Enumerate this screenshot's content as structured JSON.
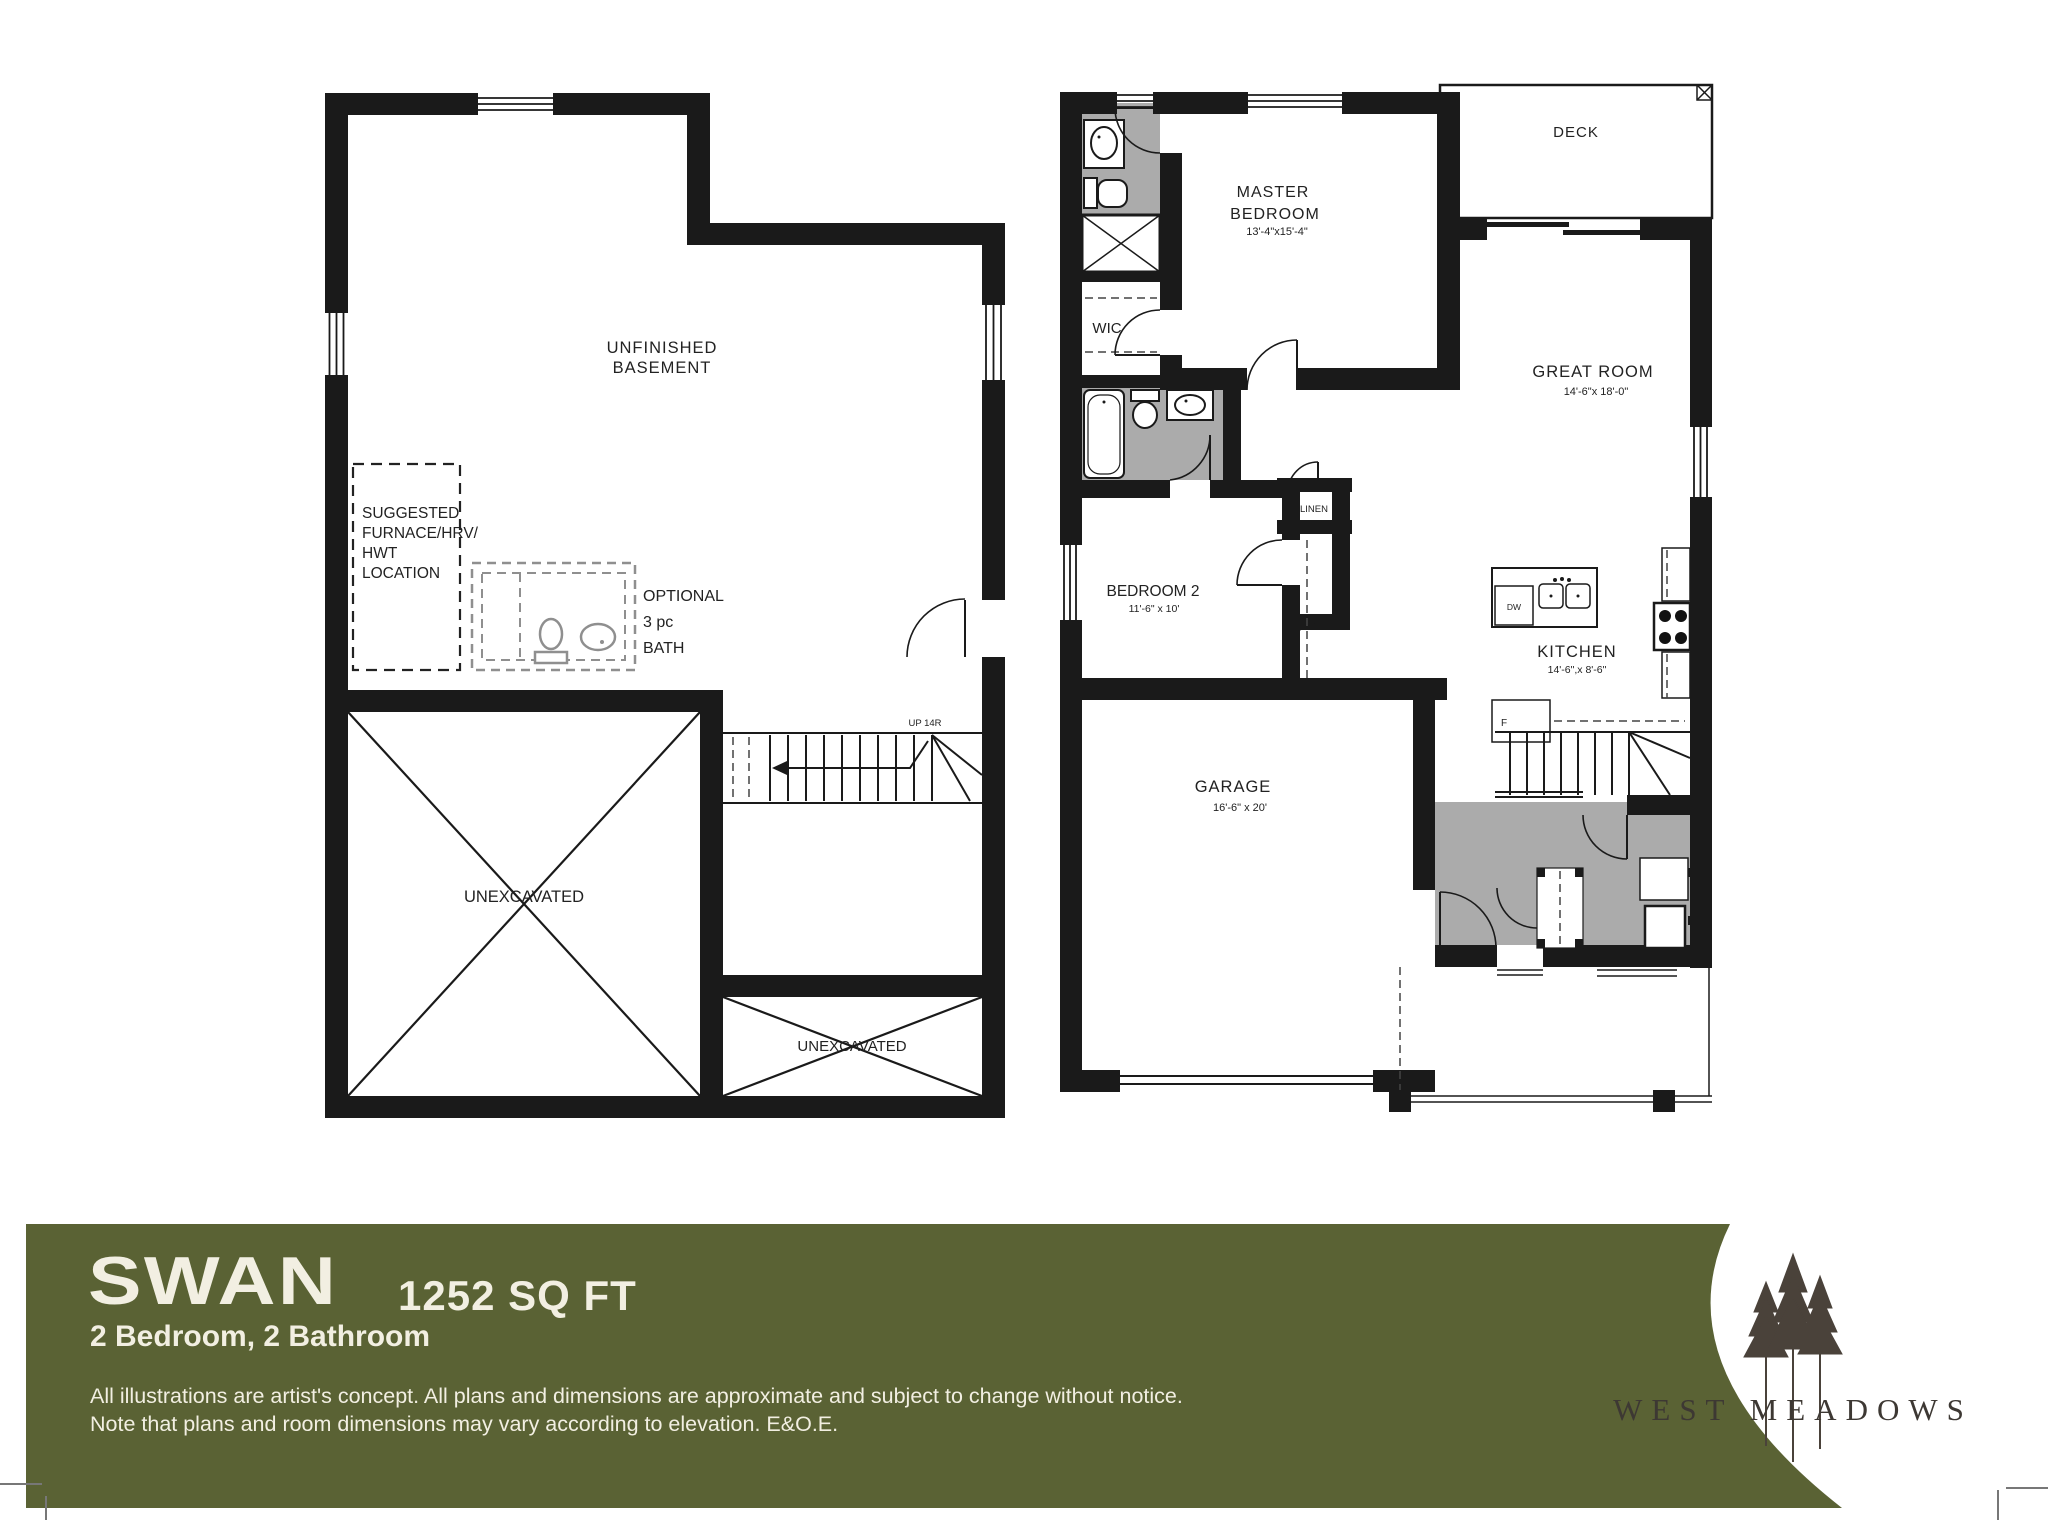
{
  "colors": {
    "banner_green": "#5A6234",
    "banner_text": "#F2EFE2",
    "wall": "#1a1a1a",
    "shading_gray": "#ABABAB",
    "logo_brown": "#4A423A",
    "logo_text": "#3D3833"
  },
  "banner": {
    "model_name": "SWAN",
    "area": "1252 SQ FT",
    "configuration": "2 Bedroom, 2 Bathroom",
    "disclaimer_line1": "All illustrations are artist's concept. All plans and dimensions are approximate and subject to change without notice.",
    "disclaimer_line2": "Note that plans and room dimensions may vary according to elevation. E&O.E."
  },
  "brand": {
    "name": "WEST MEADOWS",
    "logo_icon": "three-pine-trees"
  },
  "basement_plan": {
    "title_line1": "UNFINISHED",
    "title_line2": "BASEMENT",
    "furnace_label_lines": [
      "SUGGESTED",
      "FURNACE/HRV/",
      "HWT",
      "LOCATION"
    ],
    "optional_bath_lines": [
      "OPTIONAL",
      "3 pc",
      "BATH"
    ],
    "unexcavated_main": "UNEXCAVATED",
    "unexcavated_secondary": "UNEXCAVATED",
    "stair_label": "UP 14R"
  },
  "main_plan": {
    "deck": {
      "name": "DECK"
    },
    "master_bedroom": {
      "name_line1": "MASTER",
      "name_line2": "BEDROOM",
      "dims": "13'-4\"x15'-4\""
    },
    "wic": {
      "name": "WIC"
    },
    "great_room": {
      "name": "GREAT ROOM",
      "dims": "14'-6\"x 18'-0\""
    },
    "bedroom2": {
      "name": "BEDROOM 2",
      "dims": "11'-6\" x 10'"
    },
    "kitchen": {
      "name": "KITCHEN",
      "dims": "14'-6\",x 8'-6\""
    },
    "garage": {
      "name": "GARAGE",
      "dims": "16'-6\" x 20'"
    },
    "linen": {
      "name": "LINEN"
    },
    "appliances": {
      "dishwasher": "DW",
      "fridge": "F"
    }
  }
}
